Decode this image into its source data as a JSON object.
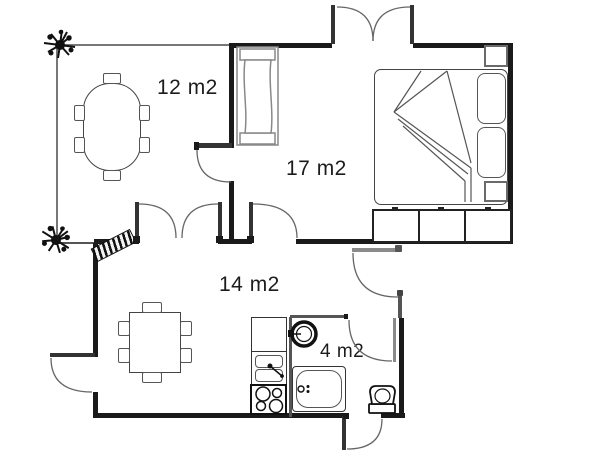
{
  "floor_plan": {
    "title": "apartment-floor-plan",
    "rooms": [
      {
        "id": "dining-room",
        "label": "12 m2"
      },
      {
        "id": "bedroom",
        "label": "17 m2"
      },
      {
        "id": "living-kitchen",
        "label": "14 m2"
      },
      {
        "id": "bathroom",
        "label": "4 m2"
      }
    ],
    "radiator": {
      "arrows_row": "↕↕↕"
    },
    "furniture": [
      "oval-dining-table-with-six-chairs",
      "radiator",
      "double-bed-with-two-pillows-and-folded-blanket",
      "nightstand-top",
      "nightstand-bottom",
      "three-section-wardrobe",
      "square-table-with-six-chairs",
      "kitchen-counter",
      "double-sink",
      "four-burner-stove",
      "round-wash-basin",
      "bathtub",
      "toilet",
      "plant-top-left-corner",
      "plant-bottom-left-corner",
      "doormat"
    ],
    "colors": {
      "wall": "#1a1a1a",
      "outline": "#444",
      "background": "#ffffff"
    }
  }
}
